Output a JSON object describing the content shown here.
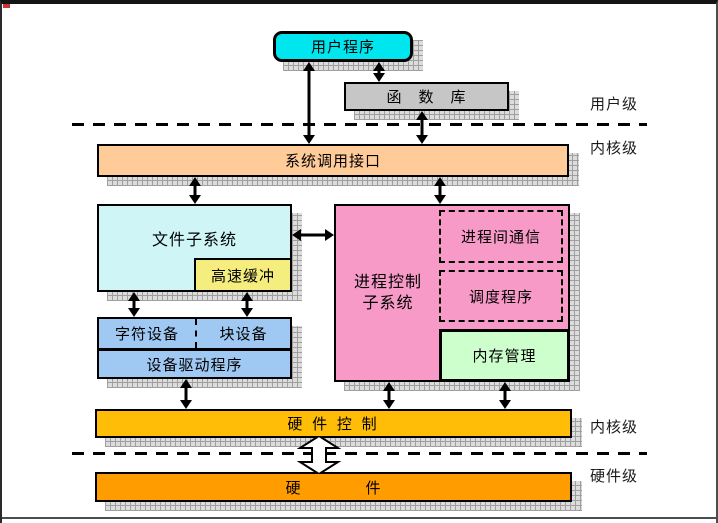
{
  "diagram": {
    "title_hint": "UNIX kernel architecture block diagram",
    "boxes": {
      "user_program": "用户程序",
      "function_library": "函　数　库",
      "syscall_interface": "系统调用接口",
      "file_subsystem": "文件子系统",
      "buffer_cache": "高速缓冲",
      "process_subsystem_line1": "进程控制",
      "process_subsystem_line2": "子系统",
      "ipc": "进程间通信",
      "scheduler": "调度程序",
      "memory_mgmt": "内存管理",
      "char_device": "字符设备",
      "block_device": "块设备",
      "device_driver": "设备驱动程序",
      "hardware_control": "硬 件 控 制",
      "hardware": "硬　　　　件"
    },
    "level_labels": {
      "user_level": "用户级",
      "kernel_level_top": "内核级",
      "kernel_level_bottom": "内核级",
      "hardware_level": "硬件级"
    },
    "colors": {
      "user_program": "#00E6EE",
      "function_library": "#C6C6C6",
      "syscall_interface": "#FFCC99",
      "file_subsystem": "#CFF5F7",
      "buffer_cache": "#F5EE7E",
      "process_subsystem": "#F89AC8",
      "memory_mgmt": "#CCFFCC",
      "device_box": "#9FC9F2",
      "hardware_control": "#FFBD08",
      "hardware": "#FF9C00",
      "shadow_hatch": "#9f9f9f",
      "line": "#000000"
    }
  }
}
